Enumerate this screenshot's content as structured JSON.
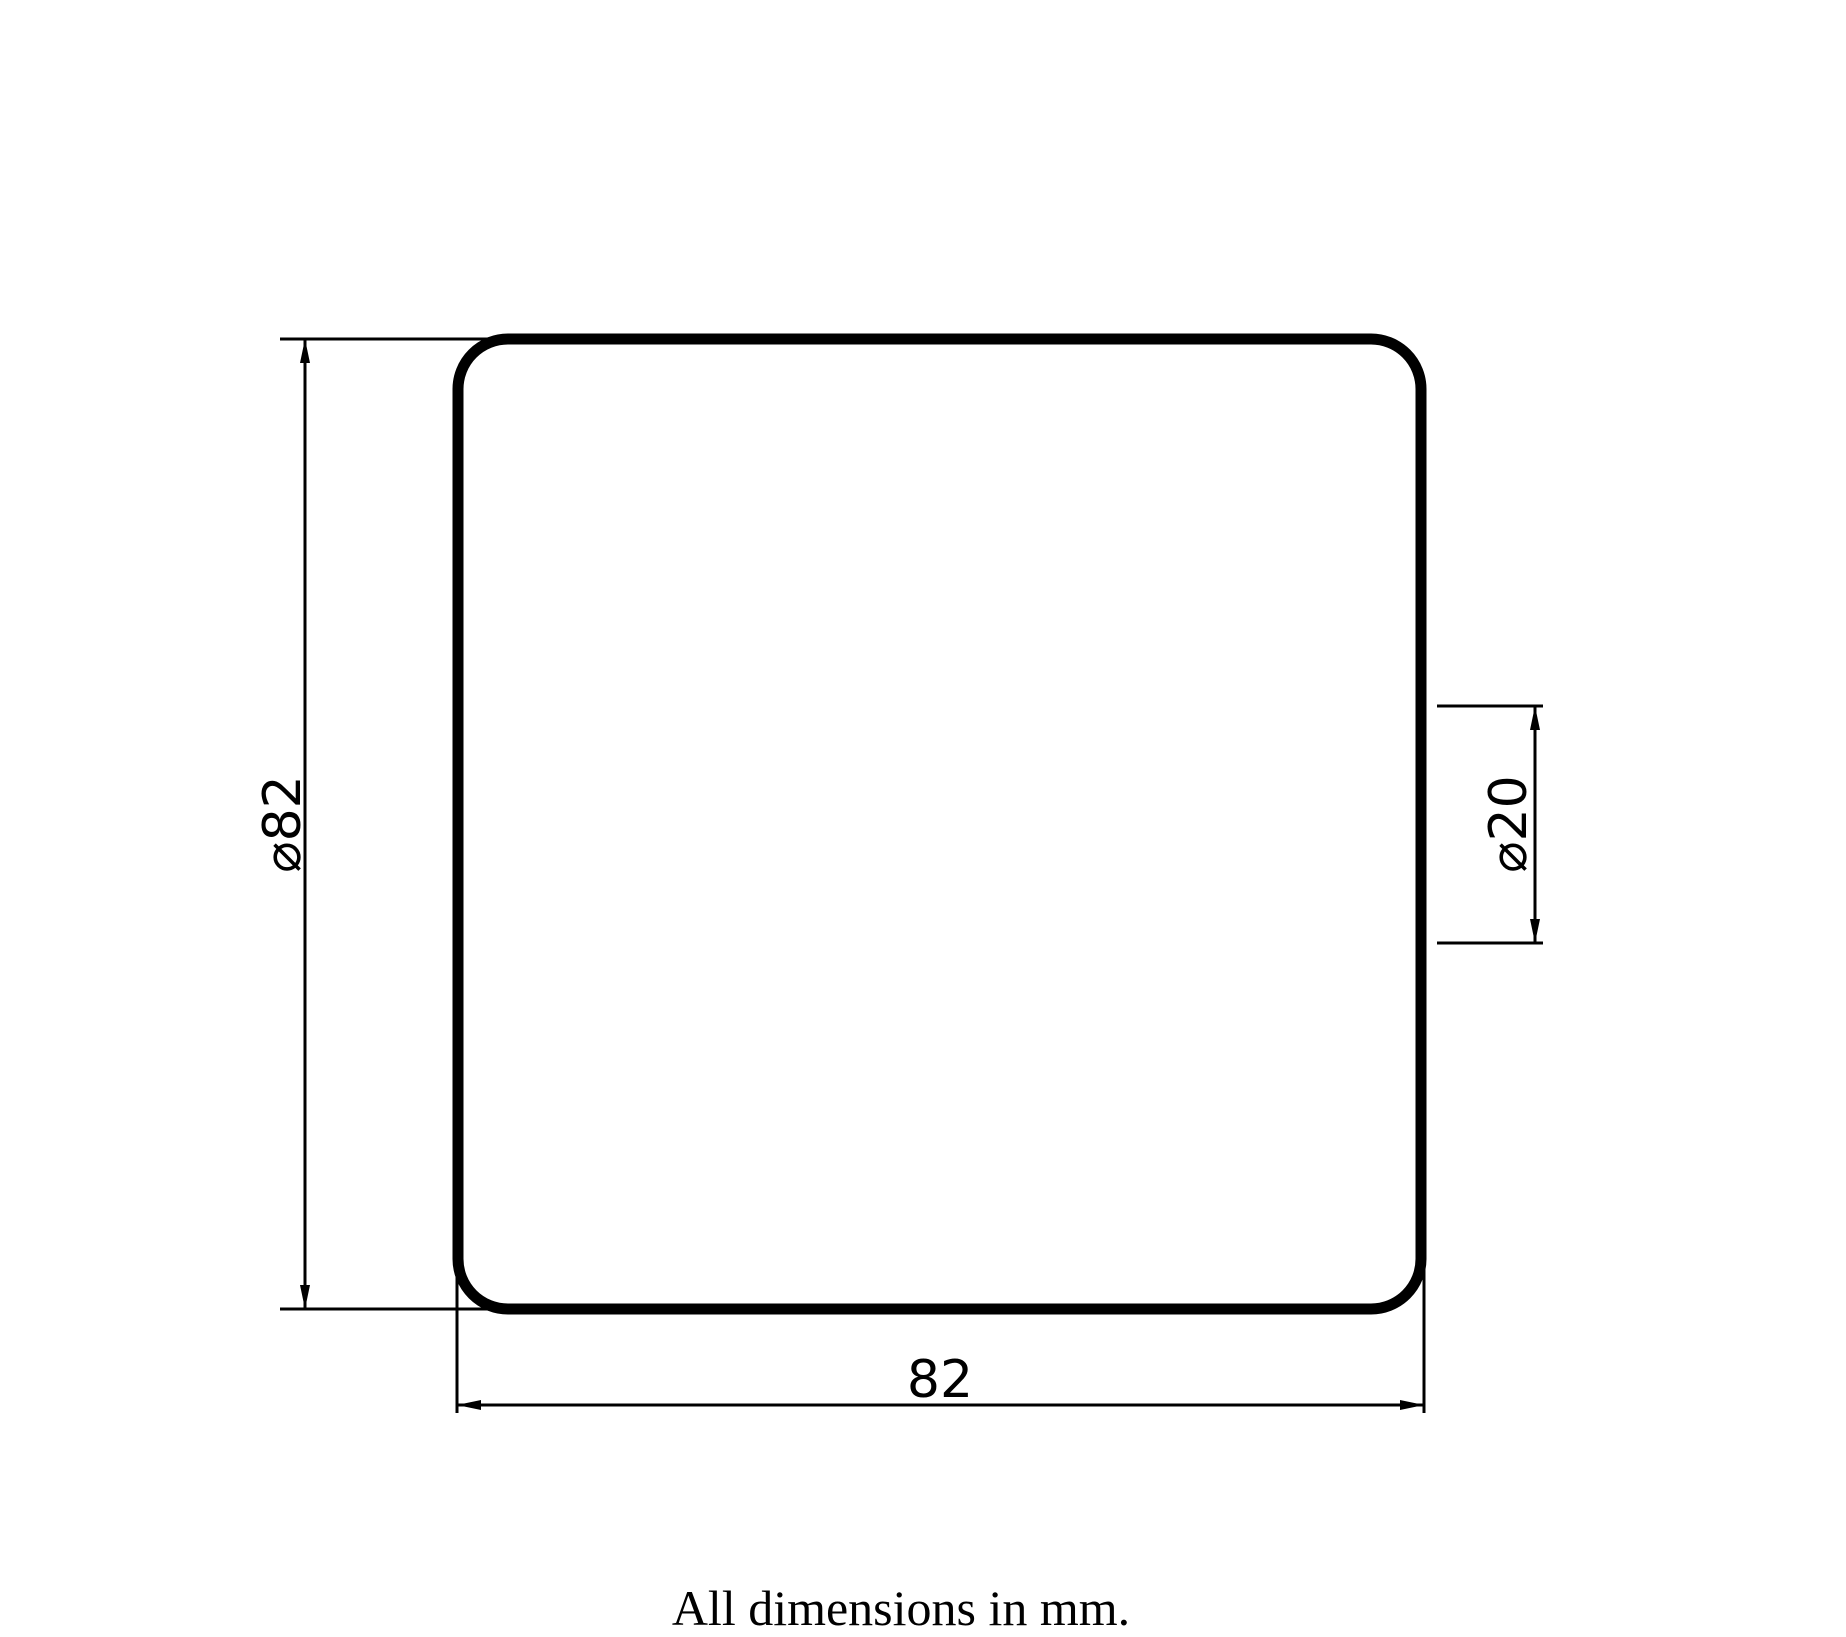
{
  "page": {
    "background_color": "#ffffff",
    "ink_color": "#000000"
  },
  "drawing": {
    "view": "front-face-of-square-pad",
    "caption": "All dimensions in mm.",
    "dimensions": [
      {
        "id": "overall-size-vertical",
        "label": "⌀82",
        "value": 82
      },
      {
        "id": "bore-diameter",
        "label": "⌀20",
        "value": 20
      },
      {
        "id": "overall-size-horizontal",
        "label": "82",
        "value": 82
      }
    ]
  }
}
